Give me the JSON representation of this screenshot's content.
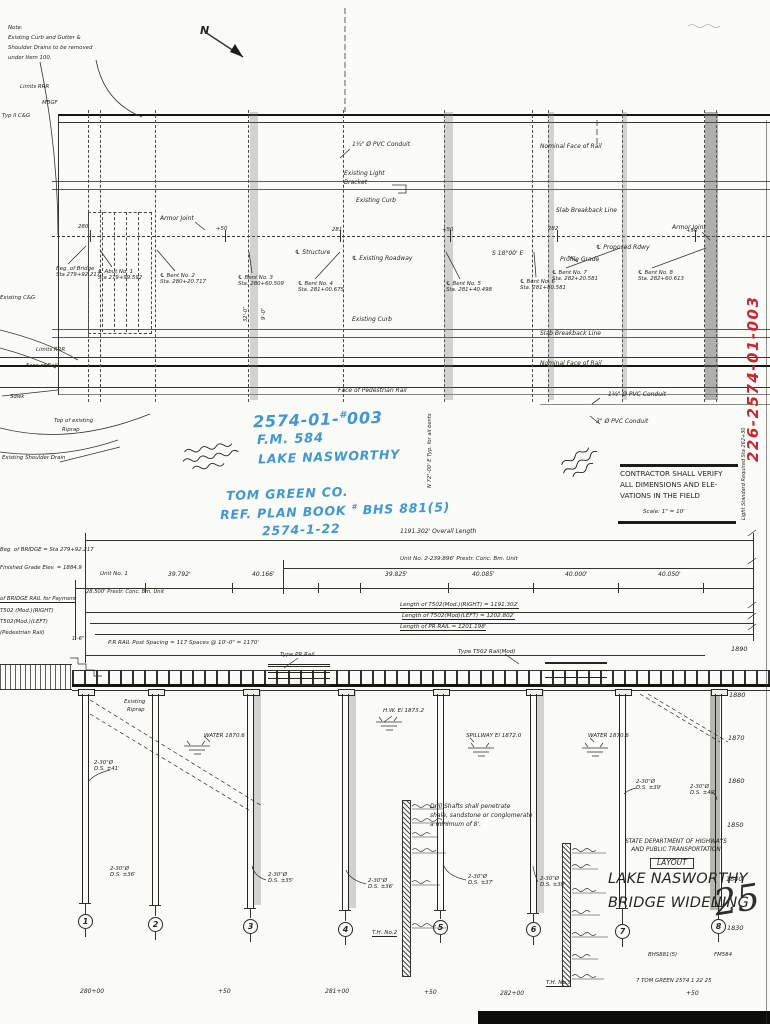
{
  "sheet": {
    "north_label": "N",
    "red_stamp": "226-2574-01-003",
    "scale_note": "Scale: 1\" = 10'",
    "sheet_number_script": "25"
  },
  "top_note": {
    "l1": "Note:",
    "l2": "Existing Curb and Gutter &",
    "l3": "Shoulder Drains to be removed",
    "l4": "under Item 100."
  },
  "plan": {
    "labels": {
      "limits_rrr_top": "Limits RRR",
      "mbgf": "MBGF",
      "typ2_cg": "Typ II C&G",
      "existing_cg": "Existing C&G",
      "limits_rrr_mid": "Limits RRR",
      "face_of_rail": "Face of Rail",
      "sdwk": "Sdwk",
      "top_riprap_1": "Top of existing",
      "top_riprap_2": "Riprap",
      "existing_shoulder_drain": "Existing Shoulder Drain",
      "pvc_conduit_top": "1½\" Ø PVC Conduit",
      "existing_light_1": "Existing Light",
      "existing_light_2": "Bracket",
      "existing_curb_top": "Existing Curb",
      "nominal_face_top": "Nominal Face of Rail",
      "slab_breakback_top": "Slab Breakback Line",
      "armor_joint_left": "Armor Joint",
      "armor_joint_right": "Armor Joint",
      "cl_structure": "℄ Structure",
      "cl_existing_roadway": "℄ Existing Roadway",
      "skew": "S 18°00' E",
      "cl_proposed_rdwy": "℄ Proposed Rdwy",
      "profile_grade": "Profile Grade",
      "existing_curb_bottom": "Existing Curb",
      "slab_breakback_bottom": "Slab Breakback Line",
      "nominal_face_bottom": "Nominal Face of Rail",
      "face_ped_rail": "Face of Pedestrian Rail",
      "pvc_conduit_r1": "3\" Ø PVC Conduit",
      "pvc_conduit_r2": "1½\" Ø PVC Conduit",
      "dim_32": "32'-0\"",
      "dim_9": "9'-0\"",
      "bearing_note": "N 72°-00' E  Typ. for all bents",
      "light_standard": "Light Standard Required  Sta 262+30"
    },
    "stations": [
      "280",
      "+50",
      "281",
      "+50",
      "282",
      "+50"
    ],
    "bent_callouts": [
      {
        "l1": "Beg. of Bridge",
        "l2": "Sta 279+92.217"
      },
      {
        "l1": "℄ Abut No. 1",
        "l2": "Sta 279+99.592"
      },
      {
        "l1": "℄ Bent No. 2",
        "l2": "Sta. 280+20.717"
      },
      {
        "l1": "℄ Bent No. 3",
        "l2": "Sta. 280+60.509"
      },
      {
        "l1": "℄ Bent No. 4",
        "l2": "Sta. 281+00.675"
      },
      {
        "l1": "℄ Bent No. 5",
        "l2": "Sta. 281+40.498"
      },
      {
        "l1": "℄ Bent No. 6",
        "l2": "Sta. 281+80.581"
      },
      {
        "l1": "℄ Bent No. 7",
        "l2": "Sta. 282+20.581"
      },
      {
        "l1": "℄ Bent No. 8",
        "l2": "Sta. 282+60.613"
      }
    ]
  },
  "blue_notes": {
    "l1a": "2574-01-",
    "l1sup": "#",
    "l1b": "003",
    "l2": "F.M. 584",
    "l3": "LAKE NASWORTHY",
    "l4": "TOM GREEN CO.",
    "l5a": "REF. PLAN BOOK",
    "l5sup": "#",
    "l5b": "BHS 881(5)",
    "l6": "2574-1-22"
  },
  "contractor_note": {
    "l1": "CONTRACTOR SHALL VERIFY",
    "l2": "ALL DIMENSIONS AND ELE-",
    "l3": "VATIONS IN THE FIELD"
  },
  "elevation": {
    "overall_length": "1191.302' Overall Length",
    "unit2": "Unit No. 2-239.896' Prestr. Conc. Bm. Unit",
    "unit1_l1": "Unit No. 1",
    "unit1_l2": "28.500' Prestr. Conc. Bm. Unit",
    "spans": [
      "39.792'",
      "40.166'",
      "39.825'",
      "40.085'",
      "40.000'",
      "40.050'"
    ],
    "rail_right": "Length of T502(Mod.)(RIGHT) = 1191.302'",
    "rail_left": "Length of T502(Mod)(LEFT) = 1202.802'",
    "pr_rail": "Length of PR RAIL = 1201.198'",
    "dim_1_6": "1'-6\"",
    "post_spacing": "P.R RAIL Post Spacing = 117 Spaces @ 10'-0\" = 1170'",
    "beg_bridge": "Beg. of BRIDGE = Sta 279+92.217",
    "fin_grade": "Finished Grade Elev. = 1884.9",
    "rail_payment": "of BRIDGE RAIL for Payment",
    "t502_right": "T502 (Mod.)(RIGHT)",
    "t502_left": "T502(Mod.)(LEFT)",
    "ped_rail": "(Pedestrian Rail)",
    "type_pr_rail": "Type PR Rail",
    "type_t502": "Type T502 Rail(Mod)",
    "riprap_l1": "Existing",
    "riprap_l2": "Riprap",
    "hw_el": "H.W. El 1873.2",
    "spillway_el": "SPILLWAY El 1872.0",
    "water_el_1": "WATER 1870.6",
    "water_el_2": "WATER 1870.6",
    "drill_note_l1": "Drill Shafts shall penetrate",
    "drill_note_l2": "shale, sandstone or conglomerate",
    "drill_note_l3": "a minimum of 8'.",
    "th2": "T.H. No.2",
    "th3": "T.H. No.3",
    "axis": [
      "1890",
      "1880",
      "1870",
      "1860",
      "1850",
      "1840",
      "1830"
    ],
    "stations": [
      "280+00",
      "+50",
      "281+00",
      "+50",
      "282+00",
      "+50"
    ],
    "bents": [
      {
        "num": "1",
        "shaft": "2-30\"Ø",
        "depth": "D.S. ±41'"
      },
      {
        "num": "2",
        "shaft": "2-30\"Ø",
        "depth": "D.S. ±36'"
      },
      {
        "num": "3",
        "shaft": "2-30\"Ø",
        "depth": "D.S. ±35'"
      },
      {
        "num": "4",
        "shaft": "2-30\"Ø",
        "depth": "D.S. ±36'"
      },
      {
        "num": "5",
        "shaft": "2-30\"Ø",
        "depth": "D.S. ±37'"
      },
      {
        "num": "6",
        "shaft": "2-30\"Ø",
        "depth": "D.S. ±38'"
      },
      {
        "num": "7",
        "shaft": "2-30\"Ø",
        "depth": "D.S. ±39'"
      },
      {
        "num": "8",
        "shaft": "2-30\"Ø",
        "depth": "D.S. ±40'"
      }
    ]
  },
  "title_block": {
    "dept_l1": "STATE DEPARTMENT OF HIGHWAYS",
    "dept_l2": "AND PUBLIC TRANSPORTATION",
    "sheet_title": "LAYOUT",
    "project_l1": "LAKE NASWORTHY",
    "project_l2": "BRIDGE WIDENING",
    "ref_left": "BHS881(5)",
    "ref_right": "FM584",
    "county_row": "7   TOM GREEN  2574    1    22    25"
  }
}
